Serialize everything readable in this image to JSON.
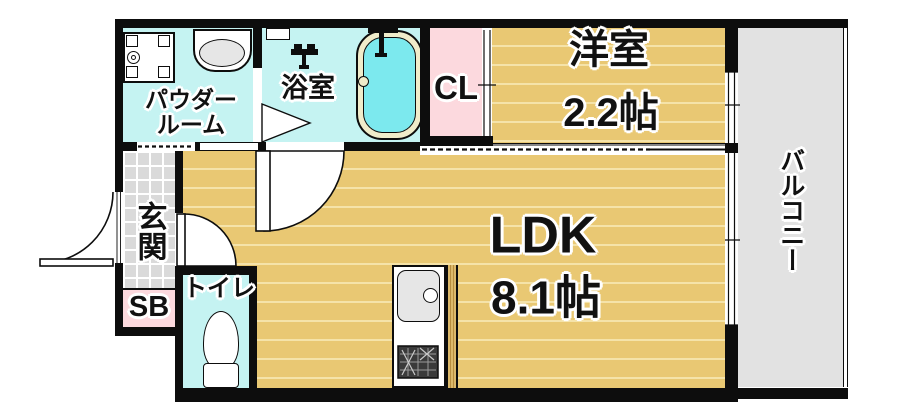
{
  "plan": {
    "type": "apartment-floor-plan",
    "labels": {
      "powder_room_line1": "パウダー",
      "powder_room_line2": "ルーム",
      "bathroom": "浴室",
      "closet": "CL",
      "western_room": "洋室",
      "western_room_size": "2.2帖",
      "ldk": "LDK",
      "ldk_size": "8.1帖",
      "balcony": "バルコニー",
      "entrance": "玄関",
      "shoe_box": "SB",
      "toilet": "トイレ"
    },
    "colors": {
      "wall": "#0d0d0d",
      "floor_wood": "#e9c873",
      "floor_wood_stripe": "#f5e3a9",
      "wet_room_cyan": "#c5f3f2",
      "bath_water": "#7ce9ee",
      "tub_rim": "#f0ecca",
      "closet_pink": "#fcd9de",
      "entrance_tile": "#dadada",
      "balcony_gray": "#e2e2e2",
      "counter_wood": "#dcb96a",
      "stove_dark": "#3a3a3a",
      "sink_gray": "#e6e6e6",
      "outline_text": "#111111"
    }
  }
}
